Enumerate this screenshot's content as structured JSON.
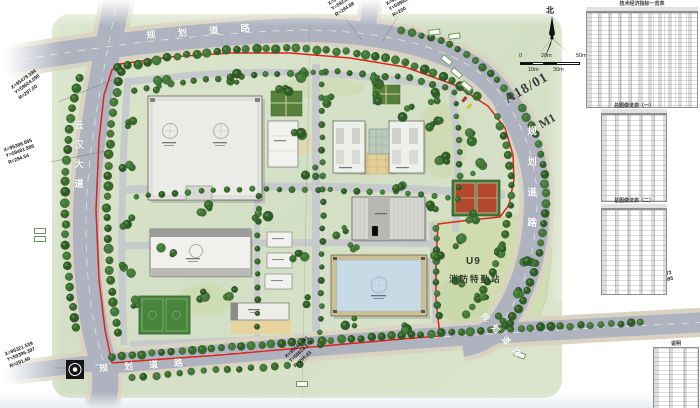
{
  "drawing": {
    "plot_label": "A18/01",
    "unit_label": "M1",
    "north_label": "北"
  },
  "scale_bar": {
    "labels": [
      "0",
      "10m",
      "20m",
      "30m",
      "50m"
    ]
  },
  "roads": {
    "left_avenue": "云汉大道",
    "top_road": "规划道路",
    "right_road": "规划道路",
    "bottom_road": "规划道路",
    "bottom_right_road": "规划道路"
  },
  "fire_station": {
    "code": "U9",
    "name": "消防特勤站"
  },
  "survey_points": {
    "nw": {
      "l1": "X=95478.394",
      "l2": "Y=59624.098",
      "l3": "R=297.00"
    },
    "w": {
      "l1": "X=95386.895",
      "l2": "Y=59481.886",
      "l3": "R=294.54"
    },
    "sw": {
      "l1": "X=95321.539",
      "l2": "Y=59396.397",
      "l3": "R=291.60"
    },
    "n1": {
      "l1": "X=95421.671",
      "l2": "Y=59235.318",
      "l3": "R=294.88"
    },
    "n2": {
      "l1": "X=95368.018",
      "l2": "Y=59908.011",
      "l3": "R=200"
    },
    "s": {
      "l1": "X=95142.681",
      "l2": "Y=59614.070",
      "l3": "R=290.43"
    },
    "se": {
      "l1": "X=95017.872",
      "l2": "Y=59842.095"
    }
  },
  "panel": {
    "table1_title": "技术经济指标一览表",
    "table2_title": "总图做法表（一）",
    "table3_title": "总图做法表（二）",
    "table4_title": "说明"
  },
  "colors": {
    "boundary_red": "#e02318",
    "road_gray": "#aeb3bf",
    "tree_green": "#33621f",
    "site_green": "#d7e1c8",
    "blue_roof": "#c6dbe6"
  }
}
